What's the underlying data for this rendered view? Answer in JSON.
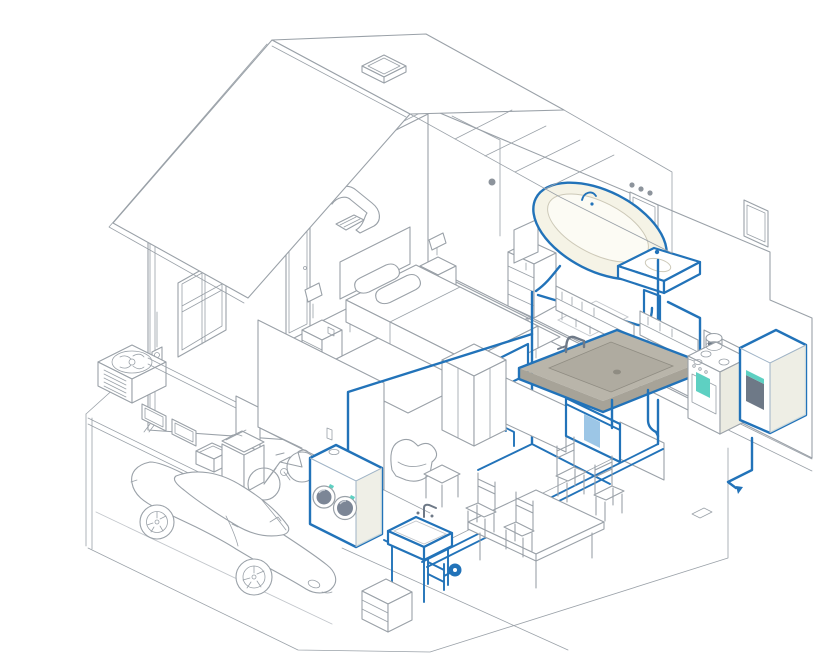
{
  "meta": {
    "description": "Isometric cutaway illustration of a two-story house with the residential hot water plumbing system highlighted in blue, from water heater to fixtures"
  },
  "colors": {
    "line": "#9aa1a8",
    "line_soft": "#c2c6cb",
    "blue": "#2273b9",
    "teal": "#5ed0c2",
    "cream": "#f5f3e6",
    "white": "#ffffff",
    "shade": "#ebebe1",
    "counter": "#b9b5aa",
    "counter_dark": "#a7a398",
    "basin": "#afaba0",
    "slate": "#6e7987",
    "door_glass": "#7c8696",
    "towel": "#9cc6e6"
  },
  "scene": {
    "exterior": [
      "gable-roof",
      "skylight",
      "attic-duct",
      "gable-window",
      "downspout",
      "hvac-condenser",
      "electric-meter",
      "garage-opening",
      "driveway"
    ],
    "upper_floor": {
      "bedroom": [
        "bed",
        "pillows",
        "headboard",
        "nightstand-left",
        "lamp-left",
        "nightstand-right",
        "lamp-right",
        "dresser",
        "tv",
        "rug",
        "door"
      ],
      "bathroom": [
        "bathtub",
        "bathtub-faucet",
        "pedestal-sink",
        "vanity-mirror",
        "vanity-lights",
        "wall-outlet",
        "wall-cabinet",
        "bath-mat"
      ]
    },
    "main_floor": {
      "kitchen": [
        "countertop-sink",
        "kitchen-faucet",
        "dishwasher",
        "dish-towel",
        "range-stove",
        "oven-towel",
        "cookware",
        "upper-shelves",
        "range-hood",
        "base-cabinets",
        "tall-cabinet"
      ],
      "utility": [
        "water-heater",
        "water-heater-display",
        "toilet"
      ],
      "dining": [
        "dining-table",
        "dining-chair",
        "dining-chair",
        "dining-chair",
        "dining-chair"
      ],
      "living": [
        "armchair",
        "side-table"
      ]
    },
    "basement_garage": {
      "garage": [
        "sports-car",
        "bicycle",
        "trash-bin",
        "storage-tote",
        "wall-door"
      ],
      "laundry": [
        "washer-dryer",
        "washer-door",
        "dryer-door",
        "utility-sink",
        "sink-faucet",
        "recirculation-pump",
        "drawer-cabinet"
      ]
    },
    "plumbing_runs": [
      "bathtub-drain",
      "pedestal-sink-supply",
      "toilet-supply",
      "kitchen-sink-supply",
      "dishwasher-supply",
      "washer-supply",
      "utility-sink-supply",
      "water-heater-inlet",
      "main-basement-run"
    ]
  }
}
